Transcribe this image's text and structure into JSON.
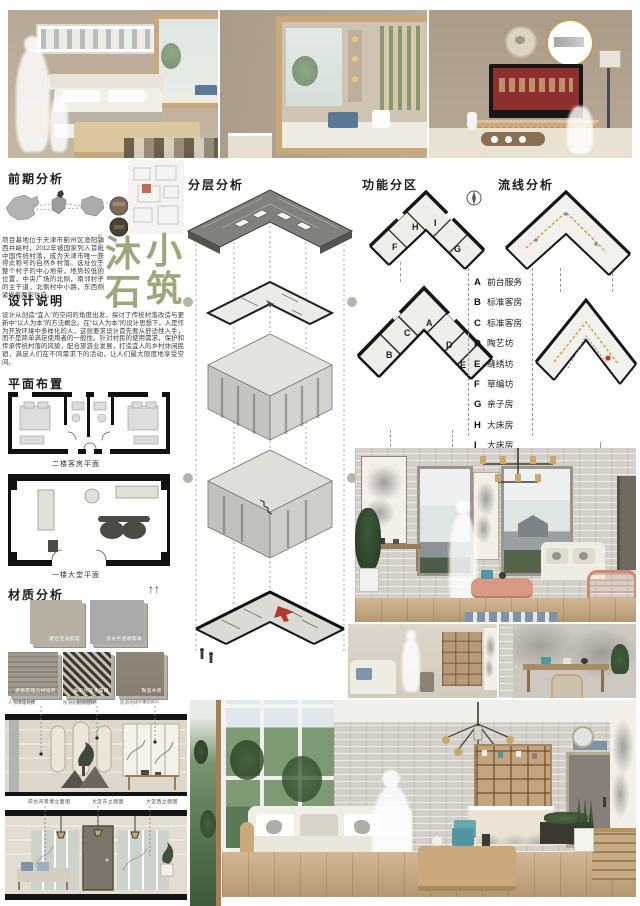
{
  "board": {
    "title_chars": {
      "c1": "沐",
      "c2": "石",
      "c3": "小",
      "c4": "筑"
    },
    "subtitle_vertical": "传统村落民宿设计",
    "accent_color": "#a2a47c"
  },
  "sections": {
    "preliminary": {
      "title": "前期分析",
      "body": "项目基地位于天津市蓟州区渔阳镇西井峪村，2012年被国家列入首批中国传统村落，成为天津市唯一获得此称号的自然乡村落。选址位于整个村子的中心地带，地势较低的位置，中央广场的北侧，南邻村子的主干道，北侧村中小路，东西侧紧挨着两家住户。"
    },
    "design": {
      "title": "设计说明",
      "body": "设计从创造“宜人”的空间的角度出发，探讨了传统村落改造与更新中“以人为本”的方法概念。在“以人为本”的设计思想下，人是作为开放环境中多样化的人，这就要求设计首先要从舒适性入手，而不是简单满足使用者的一般性。针对村民的使用需求，保护和传承传统村落的风貌，配合旅游业发展，打造宜人的乡村休闲民宿，满足人们在不同需求下的活动，让人们最大限度地享受空间。"
    },
    "plan_layout": {
      "title": "平面布置",
      "captions": [
        "二楼客房平面",
        "一楼大堂平面"
      ]
    },
    "material": {
      "title": "材质分析"
    },
    "layers": {
      "title": "分层分析"
    },
    "zoning": {
      "title": "功能分区"
    },
    "circulation": {
      "title": "流线分析"
    }
  },
  "legend": {
    "items": [
      {
        "letter": "A",
        "label": "前台服务"
      },
      {
        "letter": "B",
        "label": "标准客房"
      },
      {
        "letter": "C",
        "label": "标准客房"
      },
      {
        "letter": "D",
        "label": "陶艺坊"
      },
      {
        "letter": "E",
        "label": "缝绣坊"
      },
      {
        "letter": "F",
        "label": "草编坊"
      },
      {
        "letter": "G",
        "label": "亲子房"
      },
      {
        "letter": "H",
        "label": "大床房"
      },
      {
        "letter": "I",
        "label": "大床房"
      }
    ]
  },
  "zoning_letters": {
    "f2": [
      "F",
      "H",
      "I",
      "G"
    ],
    "f1": [
      "B",
      "C",
      "A",
      "D",
      "E"
    ]
  },
  "materials": {
    "swatches": [
      {
        "label": "硬包亚光肌理"
      },
      {
        "label": "亮光半透明玻璃"
      },
      {
        "label": "硬质肌理石材墙砖"
      },
      {
        "label": "编织纹理金属网"
      },
      {
        "label": "陶瓷木砖"
      }
    ],
    "captions": [
      "人字纹理地砖",
      "防滑耐磨烧面砖",
      "防滑地砖"
    ]
  },
  "elevations": {
    "annotations": [
      "白色文化砖",
      "木饰面格栅",
      "水墨画屏风"
    ],
    "captions": [
      "前台背景墙立面图",
      "大堂东立面图",
      "大堂西立面图"
    ]
  },
  "icons": {
    "scale_figures": "↑↑"
  }
}
